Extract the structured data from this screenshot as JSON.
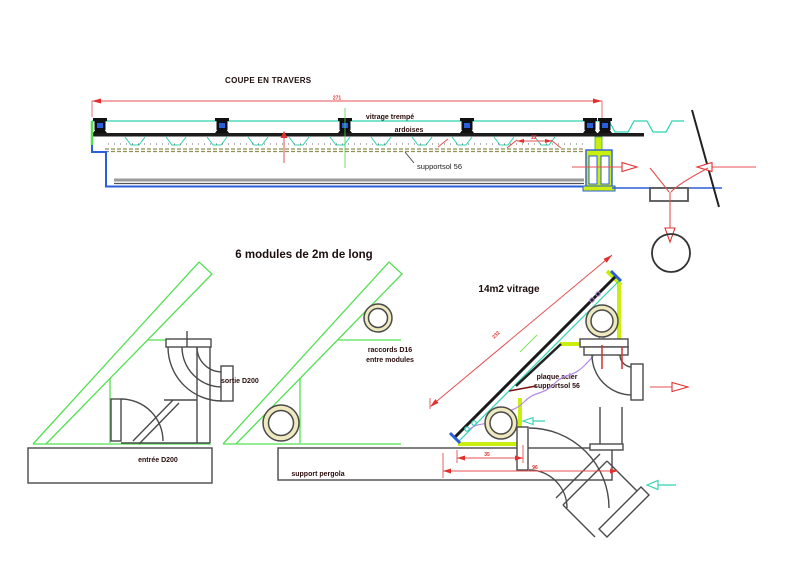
{
  "meta": {
    "background": "#ffffff",
    "drawing_type": "CAD technical drawing, solar pergola"
  },
  "colors": {
    "outline_green": "#54e052",
    "teal": "#2fd3ae",
    "chartreuse": "#c9ee10",
    "blue": "#2b5fd9",
    "dim_red": "#e65050",
    "accent_red": "#e03030",
    "dark_red": "#7a1010",
    "violet": "#b48ae8",
    "pipe_gray": "#4a4a4a",
    "olive_dashed": "#8f8f58",
    "ink": "#1d0d0d"
  },
  "coupe": {
    "title": "COUPE EN TRAVERS",
    "dim_total": "271",
    "dim_spacing": "22",
    "label_vitrage": "vitrage trempé",
    "label_ardoises": "ardoises",
    "label_supportsol": "supportsol 56"
  },
  "modules": {
    "title": "6 modules de 2m de long",
    "label_sortie": "sortie D200",
    "label_entree": "entrée D200",
    "label_raccords_1": "raccords D16",
    "label_raccords_2": "entre modules",
    "label_support": "support pergola"
  },
  "vitrage": {
    "title": "14m2 vitrage",
    "label_plaque_1": "plaque acier",
    "label_plaque_2": "supportsol 56",
    "dim_hypotenuse": "232",
    "dim_base_inner": "35",
    "dim_base_total": "96"
  }
}
